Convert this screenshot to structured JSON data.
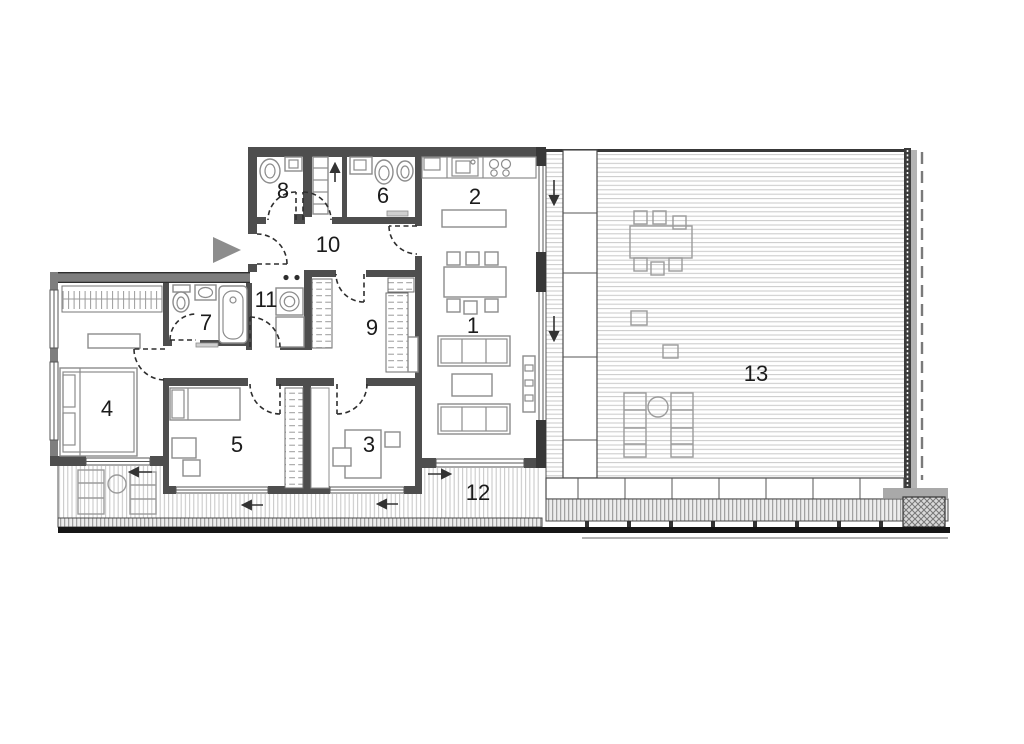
{
  "plan": {
    "rooms": {
      "r1": {
        "label": "1"
      },
      "r2": {
        "label": "2"
      },
      "r3": {
        "label": "3"
      },
      "r4": {
        "label": "4"
      },
      "r5": {
        "label": "5"
      },
      "r6": {
        "label": "6"
      },
      "r7": {
        "label": "7"
      },
      "r8": {
        "label": "8"
      },
      "r9": {
        "label": "9"
      },
      "r10": {
        "label": "10"
      },
      "r11": {
        "label": "11"
      },
      "r12": {
        "label": "12"
      },
      "r13": {
        "label": "13"
      }
    },
    "colors": {
      "wall_dark": "#4e4e4e",
      "wall_gray": "#7e7e7e",
      "deck_line": "#c9c9c9",
      "furniture_line": "#8c8c8c",
      "label_text": "#1b1b1b",
      "entrance_marker": "#8d8d8d",
      "background": "#ffffff"
    },
    "symbols": {
      "entrance_marker": "right-pointing-triangle",
      "door_swing": "dashed-quarter-arc",
      "slide_direction_arrows": [
        "down",
        "down",
        "left",
        "left",
        "left",
        "right",
        "up"
      ]
    }
  }
}
